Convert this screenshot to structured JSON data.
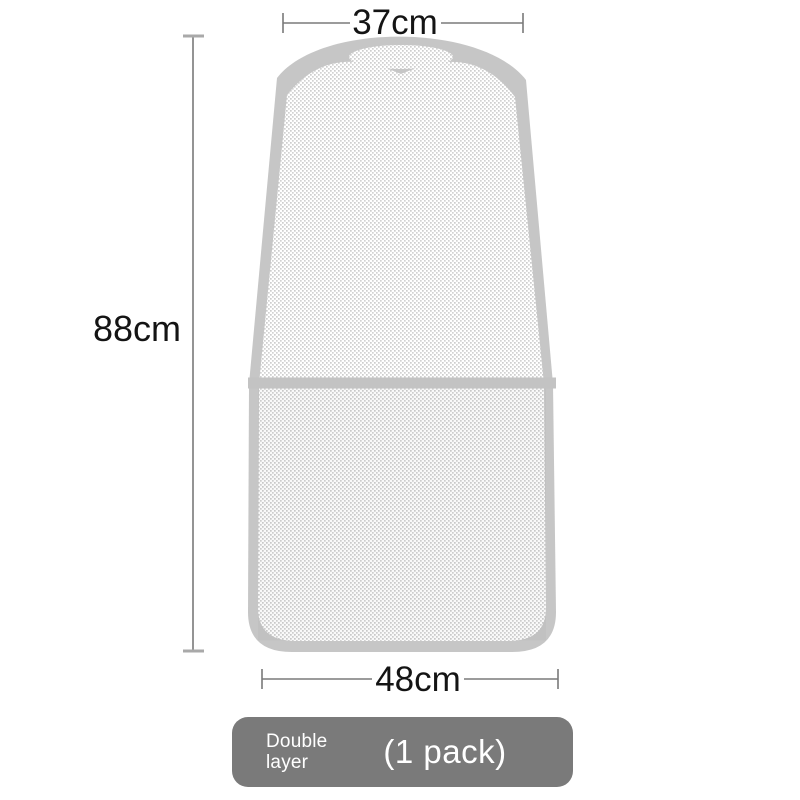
{
  "diagram": {
    "illustration": "mesh-cover-size-diagram",
    "dimensions": {
      "top_width_label": "37cm",
      "height_label": "88cm",
      "bottom_width_label": "48cm"
    }
  },
  "badge": {
    "label_line1": "Double",
    "label_line2": "layer",
    "pack_label": "(1 pack)"
  },
  "colors": {
    "trim": "#C6C6C6",
    "seam": "#C3C3C3",
    "mesh_dot": "#D2D2D2",
    "mesh_dot_alt": "#CDCDCD",
    "mesh_bg": "#FFFFFF",
    "dim_line": "#7A7A7A",
    "dim_cap": "#A9A9A9",
    "text": "#141414",
    "badge_bg": "#7A7A7A",
    "badge_text": "#FFFFFF"
  }
}
